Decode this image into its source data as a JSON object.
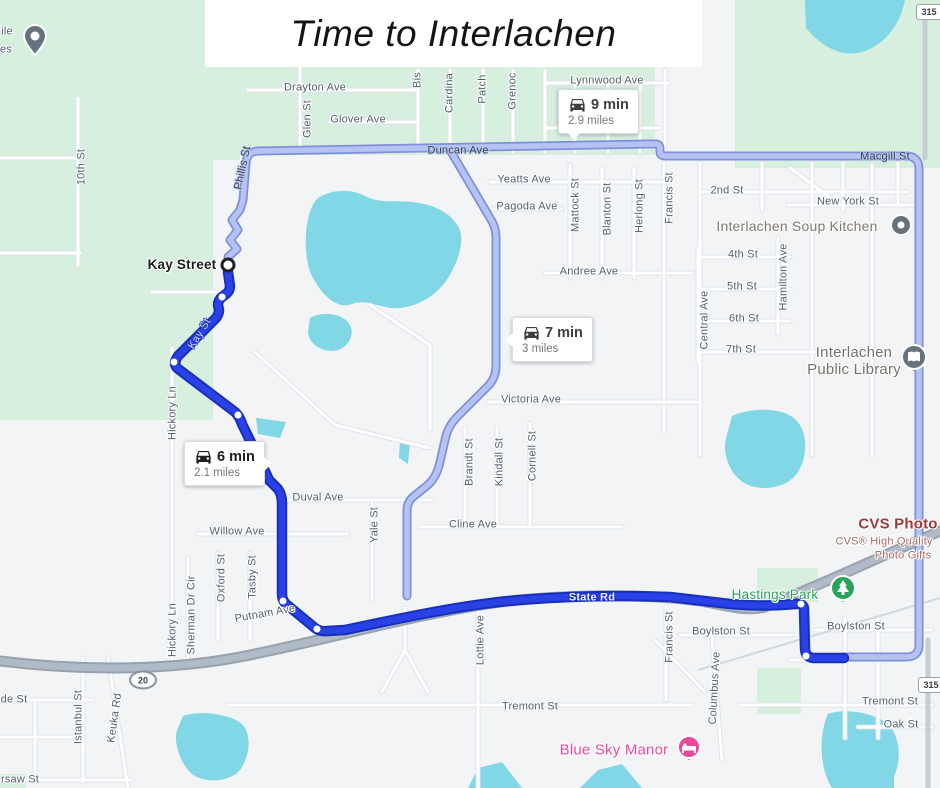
{
  "title": {
    "text": "Time to Interlachen"
  },
  "routes": {
    "selected": {
      "duration": "6 min",
      "distance": "2.1 miles"
    },
    "alt1": {
      "duration": "9 min",
      "distance": "2.9 miles"
    },
    "alt2": {
      "duration": "7 min",
      "distance": "3 miles"
    }
  },
  "origin": {
    "label": "Kay Street"
  },
  "colors": {
    "accent_route_selected": "#2b41e8",
    "route_selected_casing": "#1730b9",
    "route_alternate": "#b5c3f2",
    "route_alternate_casing": "#7e90da",
    "water": "#82d7e6",
    "park_green": "#d7efde",
    "highway_gray": "#b1bbc7",
    "poi_gray": "#66737f",
    "park_pin_green": "#27a35a",
    "lodging_pink": "#ec4899",
    "cvs_red": "#9b3838",
    "label_blue_gray": "#4f5e6d"
  },
  "map_labels": [
    {
      "text": "10th St",
      "x": 82,
      "y": 167,
      "r": -90
    },
    {
      "text": "ile",
      "x": 7,
      "y": 32,
      "r": 0
    },
    {
      "text": "es",
      "x": 6,
      "y": 50,
      "r": 0
    },
    {
      "text": "Drayton Ave",
      "x": 315,
      "y": 88,
      "r": 0
    },
    {
      "text": "Glen St",
      "x": 308,
      "y": 119,
      "r": -90
    },
    {
      "text": "Glover Ave",
      "x": 358,
      "y": 120,
      "r": 0
    },
    {
      "text": "Bis",
      "x": 418,
      "y": 80,
      "r": -90
    },
    {
      "text": "Cardina",
      "x": 450,
      "y": 93,
      "r": -90
    },
    {
      "text": "Patch",
      "x": 483,
      "y": 89,
      "r": -90
    },
    {
      "text": "Grenoc",
      "x": 513,
      "y": 91,
      "r": -90
    },
    {
      "text": "Lynnwood Ave",
      "x": 607,
      "y": 81,
      "r": 0
    },
    {
      "text": "Duncan Ave",
      "x": 458,
      "y": 151,
      "r": 0,
      "cls": "onroute-dark"
    },
    {
      "text": "Phillis St",
      "x": 243,
      "y": 168,
      "r": -78,
      "cls": "onroute-dark"
    },
    {
      "text": "Yeatts Ave",
      "x": 524,
      "y": 180,
      "r": 0
    },
    {
      "text": "Pagoda Ave",
      "x": 527,
      "y": 207,
      "r": 0
    },
    {
      "text": "Mattock St",
      "x": 576,
      "y": 205,
      "r": -90
    },
    {
      "text": "Blanton St",
      "x": 608,
      "y": 209,
      "r": -90
    },
    {
      "text": "Herlong St",
      "x": 640,
      "y": 206,
      "r": -90
    },
    {
      "text": "Francis St",
      "x": 670,
      "y": 198,
      "r": -90
    },
    {
      "text": "2nd St",
      "x": 727,
      "y": 191,
      "r": 0
    },
    {
      "text": "New York St",
      "x": 848,
      "y": 202,
      "r": 0
    },
    {
      "text": "Interlachen Soup Kitchen",
      "x": 797,
      "y": 226,
      "r": 0,
      "cls": "poi"
    },
    {
      "text": "4th St",
      "x": 743,
      "y": 255,
      "r": 0
    },
    {
      "text": "5th St",
      "x": 742,
      "y": 287,
      "r": 0
    },
    {
      "text": "6th St",
      "x": 744,
      "y": 319,
      "r": 0
    },
    {
      "text": "7th St",
      "x": 741,
      "y": 350,
      "r": 0
    },
    {
      "text": "Central Ave",
      "x": 705,
      "y": 320,
      "r": -90
    },
    {
      "text": "Hamilton Ave",
      "x": 784,
      "y": 277,
      "r": -90
    },
    {
      "text": "Interlachen\nPublic Library",
      "x": 854,
      "y": 361,
      "r": 0,
      "cls": "poi-lg"
    },
    {
      "text": "Andree Ave",
      "x": 589,
      "y": 272,
      "r": 0
    },
    {
      "text": "Victoria Ave",
      "x": 531,
      "y": 400,
      "r": 0
    },
    {
      "text": "Kay Street",
      "x": 182,
      "y": 265,
      "r": 0,
      "cls": "origin-label"
    },
    {
      "text": "Kay St",
      "x": 200,
      "y": 334,
      "r": -59,
      "cls": "onroute-kay"
    },
    {
      "text": "Hickory Ln",
      "x": 173,
      "y": 413,
      "r": -90
    },
    {
      "text": "Hickory Ln",
      "x": 173,
      "y": 630,
      "r": -90
    },
    {
      "text": "Brandt St",
      "x": 470,
      "y": 462,
      "r": -90
    },
    {
      "text": "Kindall St",
      "x": 500,
      "y": 462,
      "r": -90
    },
    {
      "text": "Cornell St",
      "x": 533,
      "y": 456,
      "r": -90
    },
    {
      "text": "Yale St",
      "x": 375,
      "y": 525,
      "r": -90
    },
    {
      "text": "Cline Ave",
      "x": 473,
      "y": 525,
      "r": 0
    },
    {
      "text": "Duval Ave",
      "x": 318,
      "y": 498,
      "r": 0
    },
    {
      "text": "Willow Ave",
      "x": 237,
      "y": 532,
      "r": 0
    },
    {
      "text": "Oxford St",
      "x": 222,
      "y": 578,
      "r": -90
    },
    {
      "text": "Tasby St",
      "x": 253,
      "y": 577,
      "r": -90
    },
    {
      "text": "Sherman Dr Cir",
      "x": 192,
      "y": 615,
      "r": -90
    },
    {
      "text": "Putnam Ave",
      "x": 265,
      "y": 614,
      "r": -10
    },
    {
      "text": "State Rd",
      "x": 592,
      "y": 598,
      "r": 0,
      "cls": "onroute-light"
    },
    {
      "text": "Hastings Park",
      "x": 775,
      "y": 595,
      "r": 0,
      "cls": "park"
    },
    {
      "text": "Boylston St",
      "x": 721,
      "y": 632,
      "r": 0
    },
    {
      "text": "Boylston St",
      "x": 856,
      "y": 627,
      "r": 0
    },
    {
      "text": "Macgill St",
      "x": 885,
      "y": 157,
      "r": 0,
      "cls": "onroute-dark"
    },
    {
      "text": "CVS Photo",
      "x": 898,
      "y": 524,
      "r": 0,
      "cls": "cvs"
    },
    {
      "text": "CVS® High Quality",
      "x": 884,
      "y": 542,
      "r": 0,
      "cls": "cvs-sub"
    },
    {
      "text": "Photo Gifts",
      "x": 903,
      "y": 556,
      "r": 0,
      "cls": "cvs-sub"
    },
    {
      "text": "Lottie Ave",
      "x": 481,
      "y": 640,
      "r": -90
    },
    {
      "text": "Francis St",
      "x": 670,
      "y": 637,
      "r": -90
    },
    {
      "text": "Columbus Ave",
      "x": 715,
      "y": 688,
      "r": -87
    },
    {
      "text": "Tremont St",
      "x": 530,
      "y": 707,
      "r": 0
    },
    {
      "text": "Tremont St",
      "x": 890,
      "y": 702,
      "r": 0
    },
    {
      "text": "Oak St",
      "x": 901,
      "y": 725,
      "r": 0
    },
    {
      "text": "Blue Sky Manor",
      "x": 614,
      "y": 750,
      "r": 0,
      "cls": "pink"
    },
    {
      "text": "Istanbul St",
      "x": 79,
      "y": 717,
      "r": -90
    },
    {
      "text": "Keuka Rd",
      "x": 115,
      "y": 718,
      "r": -82
    },
    {
      "text": "de St",
      "x": 14,
      "y": 700,
      "r": 0
    },
    {
      "text": "rsaw St",
      "x": 20,
      "y": 780,
      "r": 0
    }
  ],
  "pois": [
    {
      "name": "mobile-home-pin",
      "type": "pin",
      "x": 35,
      "y": 40
    },
    {
      "name": "soup-kitchen-pin",
      "type": "dot",
      "x": 901,
      "y": 227
    },
    {
      "name": "library-pin",
      "type": "library",
      "x": 914,
      "y": 360
    },
    {
      "name": "park-pin",
      "type": "park",
      "x": 843,
      "y": 591
    },
    {
      "name": "lodging-pin",
      "type": "lodging",
      "x": 689,
      "y": 750
    }
  ],
  "shields": [
    {
      "text": "20",
      "x": 143,
      "y": 680,
      "shape": "oval"
    },
    {
      "text": "315",
      "x": 929,
      "y": 12,
      "shape": "rect"
    },
    {
      "text": "315",
      "x": 931,
      "y": 685,
      "shape": "rect"
    }
  ]
}
